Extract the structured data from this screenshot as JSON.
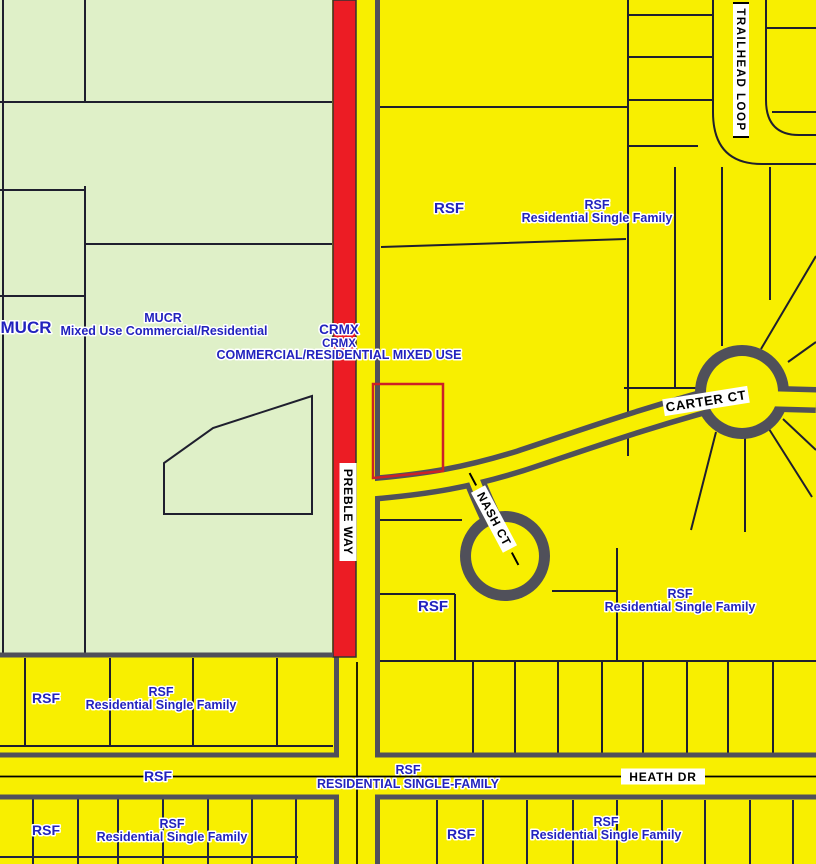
{
  "colors": {
    "parcel_yellow": "#F8EF00",
    "mucr_green": "#DFF0C8",
    "crmx_red": "#EC1C24",
    "road_casing": "#50505A",
    "parcel_line": "#1F1F2E",
    "zone_label_blue": "#2222BE",
    "street_label_bg": "#FFFFFF",
    "street_label_text": "#000000",
    "highlight_parcel_red": "#CC2127"
  },
  "zones": {
    "mucr": {
      "code": "MUCR",
      "name": "Mixed Use Commercial/Residential"
    },
    "crmx": {
      "code": "CRMX",
      "name": "COMMERCIAL/RESIDENTIAL MIXED USE"
    },
    "rsf": {
      "code": "RSF",
      "name": "Residential Single Family",
      "name_caps": "RESIDENTIAL SINGLE-FAMILY"
    }
  },
  "streets": {
    "preble_way": "PREBLE WAY",
    "trailhead_loop": "TRAILHEAD LOOP",
    "carter_ct": "CARTER CT",
    "nash_ct": "NASH CT",
    "heath_dr": "HEATH DR"
  }
}
